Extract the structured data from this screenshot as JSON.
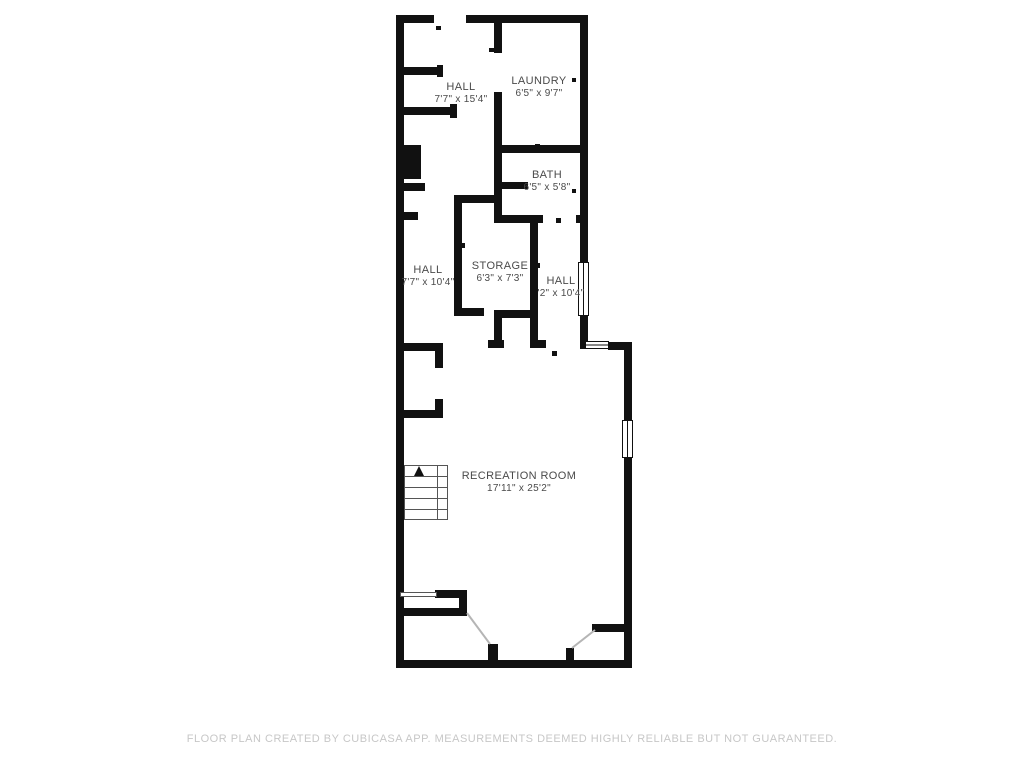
{
  "plan": {
    "rooms": [
      {
        "name": "HALL",
        "dims": "7'7\" x 15'4\""
      },
      {
        "name": "LAUNDRY",
        "dims": "6'5\" x 9'7\""
      },
      {
        "name": "BATH",
        "dims": "6'5\" x 5'8\""
      },
      {
        "name": "HALL",
        "dims": "7'7\" x 10'4\""
      },
      {
        "name": "STORAGE",
        "dims": "6'3\" x 7'3\""
      },
      {
        "name": "HALL",
        "dims": "'2\" x 10'4\""
      },
      {
        "name": "RECREATION ROOM",
        "dims": "17'11\" x 25'2\""
      }
    ],
    "footer": "FLOOR PLAN CREATED BY CUBICASA APP. MEASUREMENTS DEEMED HIGHLY RELIABLE BUT NOT GUARANTEED."
  },
  "colors": {
    "background": "#ffffff",
    "wall": "#111111",
    "label_text": "#4a4a4a",
    "footer_text": "#c7c7c7",
    "stair_line": "#555555",
    "swing_line": "#b5b5b5"
  }
}
